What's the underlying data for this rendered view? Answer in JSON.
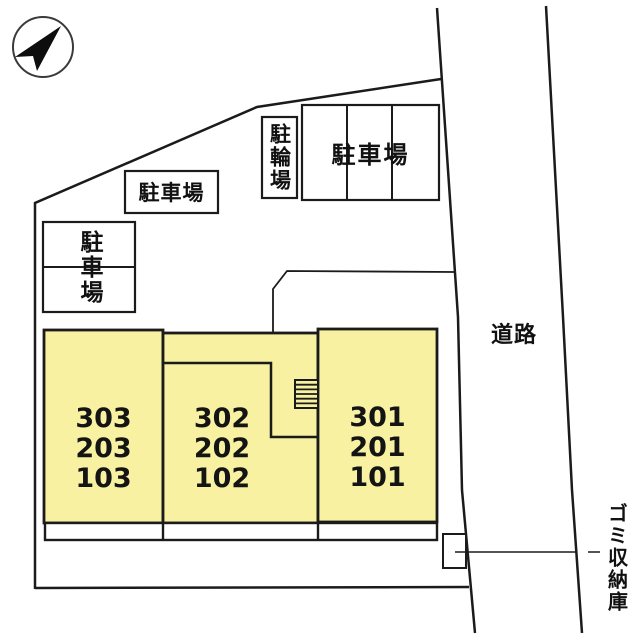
{
  "compass": {
    "icon": "north-arrow-pointing-northeast"
  },
  "road": {
    "label": "道路"
  },
  "garbage_storage": {
    "label": "ゴミ収納庫"
  },
  "bicycle_parking": {
    "label": "駐輪場"
  },
  "parking_areas": [
    {
      "position": "west",
      "label": "駐車場",
      "stalls": 2,
      "text_direction": "vertical"
    },
    {
      "position": "center",
      "label": "駐車場",
      "stalls": 1,
      "text_direction": "horizontal"
    },
    {
      "position": "northeast",
      "label": "駐車場",
      "stalls": 3,
      "text_direction": "horizontal"
    }
  ],
  "building": {
    "fill_color": "#F7F1A1",
    "columns": [
      {
        "units": [
          "303",
          "203",
          "103"
        ]
      },
      {
        "units": [
          "302",
          "202",
          "102"
        ]
      },
      {
        "units": [
          "301",
          "201",
          "101"
        ]
      }
    ]
  },
  "line_color": "#1B1B1B"
}
